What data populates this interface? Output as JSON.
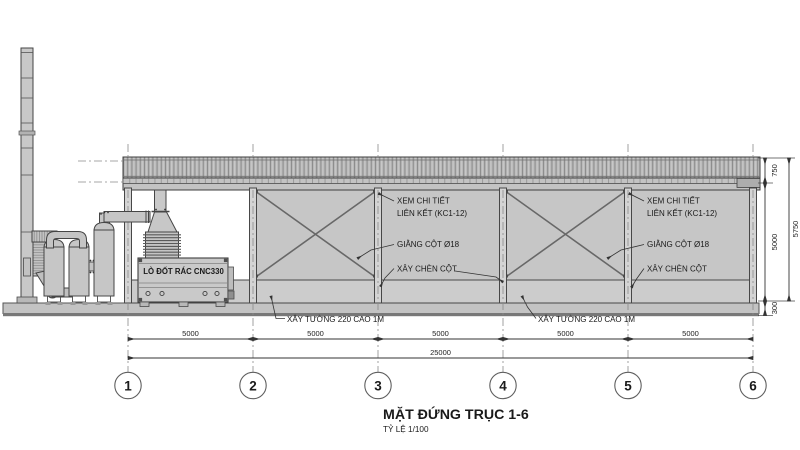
{
  "title": {
    "main": "MẶT ĐỨNG TRỤC 1-6",
    "scale": "TỶ LỆ 1/100"
  },
  "grid": {
    "bubbles": [
      "1",
      "2",
      "3",
      "4",
      "5",
      "6"
    ]
  },
  "dims": {
    "bottom": [
      "5000",
      "5000",
      "5000",
      "5000",
      "5000"
    ],
    "total": "25000",
    "right": {
      "roof": "750",
      "wall": "5000",
      "plinth": "300",
      "total": "5750"
    }
  },
  "callouts": {
    "detail1": "XEM CHI TIẾT",
    "detail2": "LIÊN KẾT (KC1-12)",
    "brace": "GIẰNG CỘT Ø18",
    "infill": "XÂY CHÈN CỘT",
    "low_wall": "XÂY TƯỜNG 220 CAO 1M"
  },
  "equipment": {
    "incinerator": "LÒ ĐỐT RÁC CNC330"
  },
  "colors": {
    "wall_gray": "#c6c6c6",
    "low_wall_gray": "#cccccc",
    "roof_gray": "#b9b9b9",
    "slab_gray": "#c3c3c3",
    "line_dark": "#3f3f3f",
    "dim_line": "#333333"
  }
}
